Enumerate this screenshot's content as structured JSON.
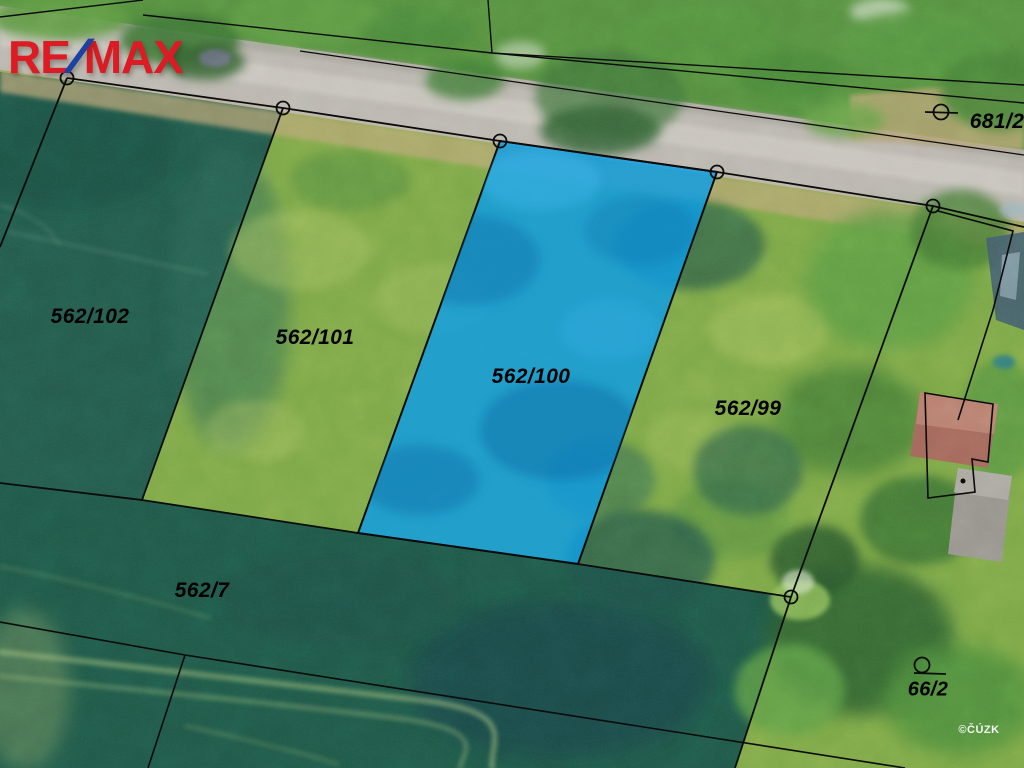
{
  "meta": {
    "type": "cadastral-aerial-map"
  },
  "logo": {
    "re": "RE",
    "slash": "/",
    "max": "MAX"
  },
  "watermark": {
    "text": "©ČÚZK"
  },
  "colors": {
    "logo_red": "#dc1b24",
    "logo_blue": "#1d41a3",
    "boundary": "#0b0b0b",
    "parcel_highlight": "#109de4",
    "label": "#000000",
    "watermark": "#f5f5f0"
  },
  "parcels": [
    {
      "id": "562-102",
      "label": "562/102",
      "highlighted": false
    },
    {
      "id": "562-101",
      "label": "562/101",
      "highlighted": false
    },
    {
      "id": "562-100",
      "label": "562/100",
      "highlighted": true
    },
    {
      "id": "562-99",
      "label": "562/99",
      "highlighted": false
    },
    {
      "id": "562-7",
      "label": "562/7",
      "highlighted": false
    },
    {
      "id": "681-2",
      "label": "681/2",
      "highlighted": false
    },
    {
      "id": "66-2",
      "label": "66/2",
      "highlighted": false
    }
  ]
}
